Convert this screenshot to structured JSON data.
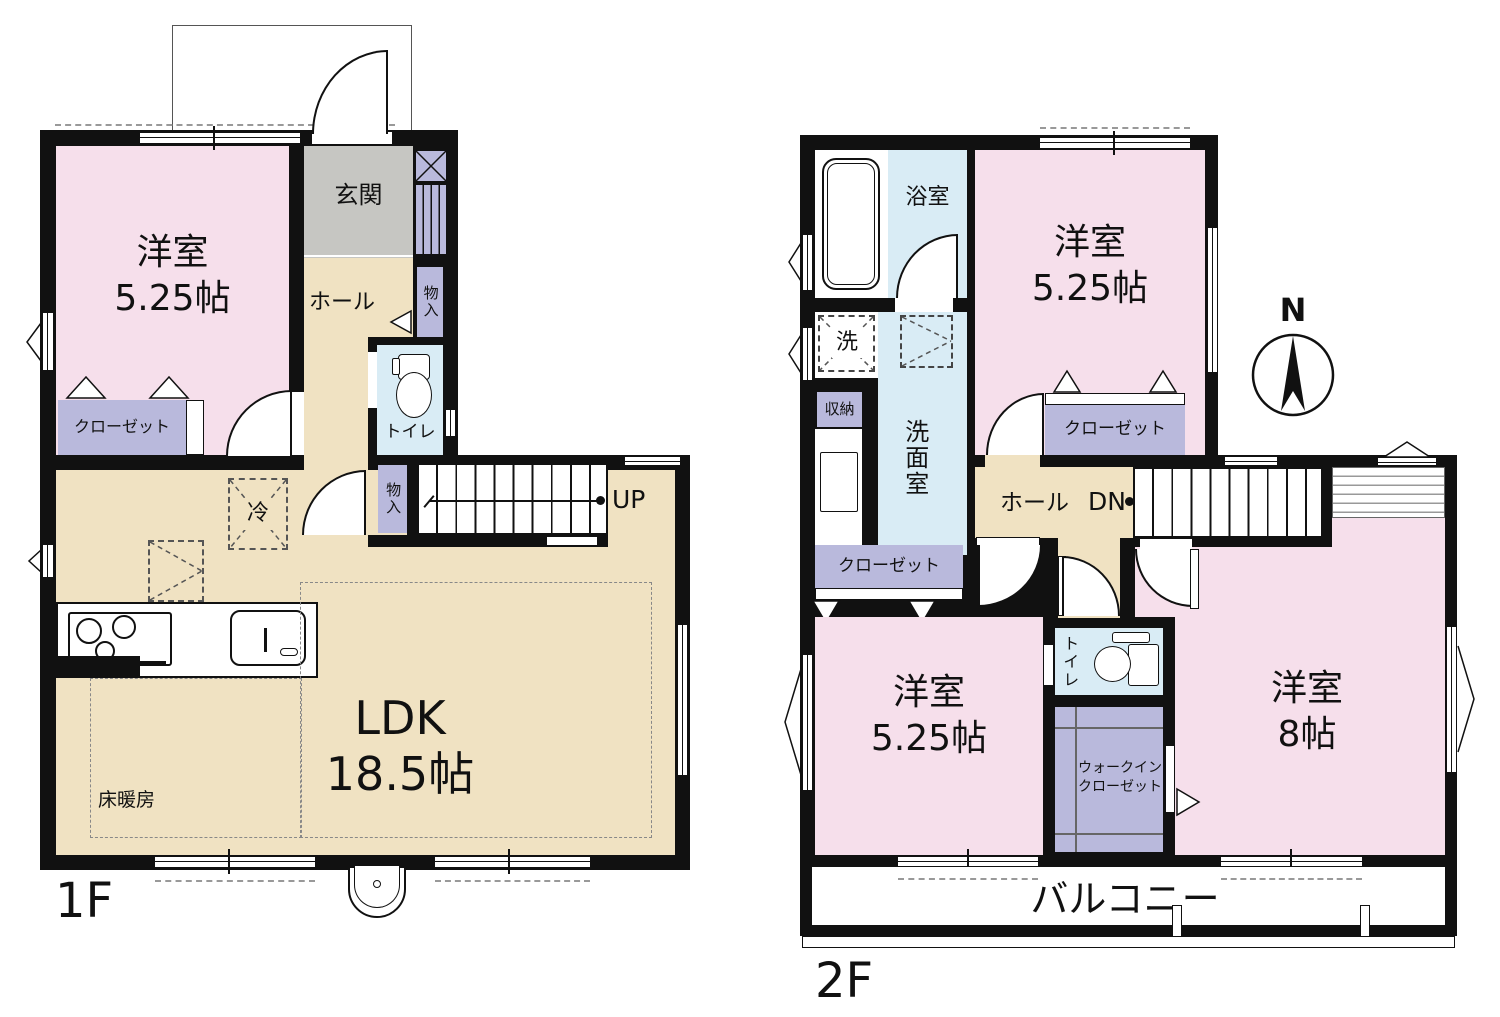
{
  "compass": {
    "north": "N"
  },
  "f1": {
    "floor_label": "1F",
    "bedroom_name": "洋室",
    "bedroom_size": "5.25帖",
    "closet": "クローゼット",
    "entrance": "玄関",
    "hall": "ホール",
    "storage_hall": "物入",
    "toilet": "トイレ",
    "storage_stairs": "物入",
    "fridge": "冷",
    "up": "UP",
    "ldk_name": "LDK",
    "ldk_size": "18.5帖",
    "floor_heating": "床暖房"
  },
  "f2": {
    "floor_label": "2F",
    "bathroom": "浴室",
    "washer": "洗",
    "washroom": "洗面室",
    "storage": "収納",
    "closet_west": "クローゼット",
    "bedroom_north_name": "洋室",
    "bedroom_north_size": "5.25帖",
    "closet_north": "クローゼット",
    "hall": "ホール",
    "dn": "DN",
    "counter": "カウンター",
    "bedroom_sw_name": "洋室",
    "bedroom_sw_size": "5.25帖",
    "toilet": "トイレ",
    "wic_line1": "ウォークイン",
    "wic_line2": "クローゼット",
    "bedroom_se_name": "洋室",
    "bedroom_se_size": "8帖",
    "balcony": "バルコニー"
  },
  "colors": {
    "wall": "#111111",
    "room_pink": "#f6dfeb",
    "room_beige": "#f0e2c2",
    "room_blue": "#d9ecf5",
    "room_purple": "#b9b9dc",
    "room_gray": "#c6c6c2"
  }
}
